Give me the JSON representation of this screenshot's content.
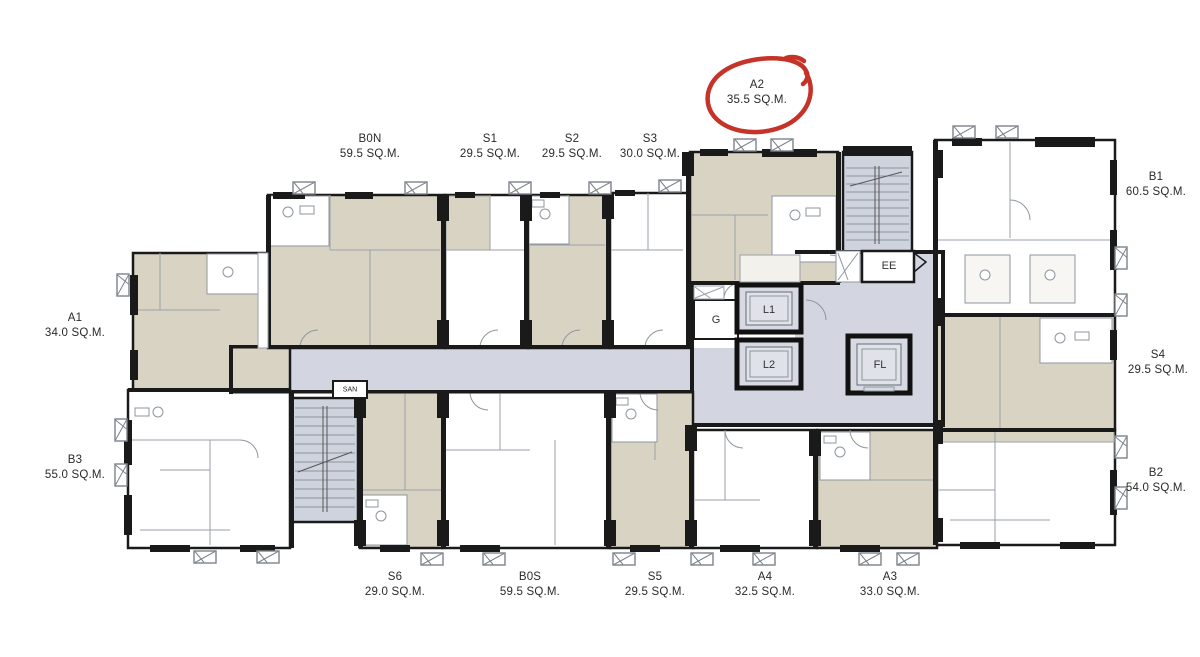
{
  "colors": {
    "wall": "#1a1a1a",
    "room_fill": "#d9d3c4",
    "corridor_fill": "#d3d6e0",
    "stair_fill": "#ced3dd",
    "annotation_red": "#c2281d",
    "thin_line": "#9aa0a8"
  },
  "units": [
    {
      "code": "A2",
      "area": "35.5 SQ.M.",
      "highlighted": true
    },
    {
      "code": "B0N",
      "area": "59.5 SQ.M."
    },
    {
      "code": "S1",
      "area": "29.5 SQ.M."
    },
    {
      "code": "S2",
      "area": "29.5 SQ.M."
    },
    {
      "code": "S3",
      "area": "30.0 SQ.M."
    },
    {
      "code": "B1",
      "area": "60.5 SQ.M."
    },
    {
      "code": "S4",
      "area": "29.5 SQ.M."
    },
    {
      "code": "B2",
      "area": "54.0 SQ.M."
    },
    {
      "code": "A1",
      "area": "34.0 SQ.M."
    },
    {
      "code": "B3",
      "area": "55.0 SQ.M."
    },
    {
      "code": "S6",
      "area": "29.0 SQ.M."
    },
    {
      "code": "B0S",
      "area": "59.5 SQ.M."
    },
    {
      "code": "S5",
      "area": "29.5 SQ.M."
    },
    {
      "code": "A4",
      "area": "32.5 SQ.M."
    },
    {
      "code": "A3",
      "area": "33.0 SQ.M."
    }
  ],
  "core": {
    "garbage_room": "G",
    "lift_1": "L1",
    "lift_2": "L2",
    "electrical_room": "EE",
    "fire_lift": "FL",
    "service_room": "SAN"
  }
}
